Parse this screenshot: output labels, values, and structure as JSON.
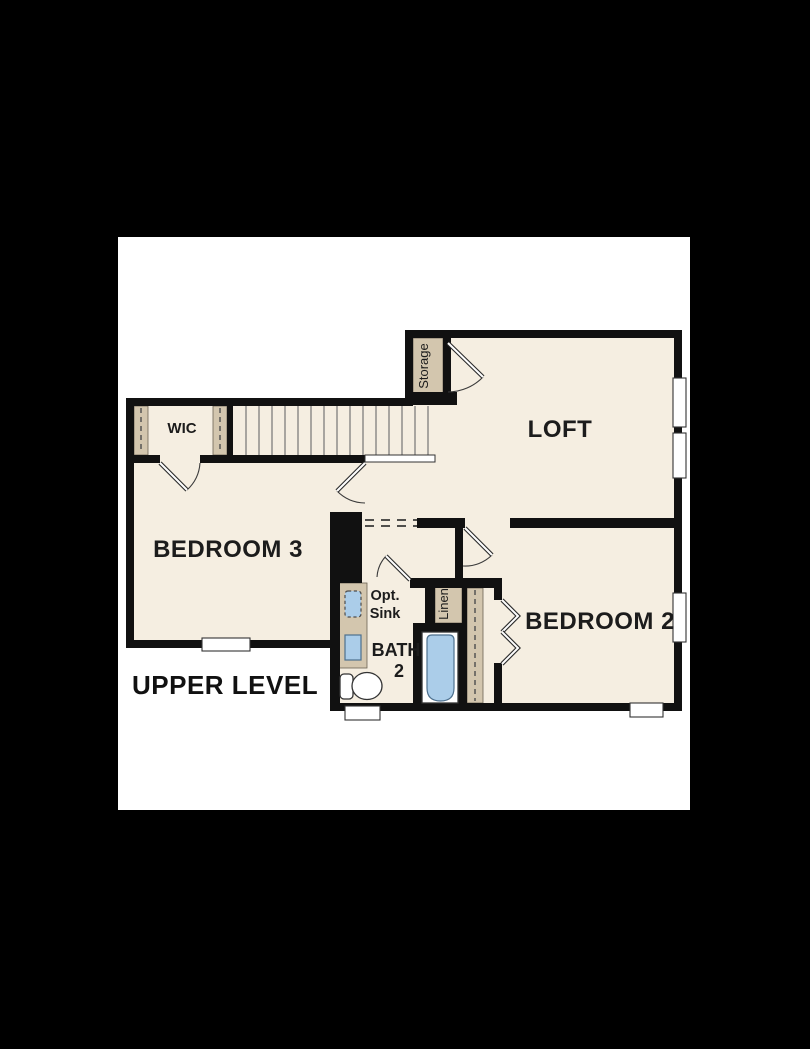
{
  "page": {
    "background_color": "#000000",
    "canvas_color": "#ffffff"
  },
  "floorplan": {
    "title": "UPPER LEVEL",
    "rooms": {
      "loft": "LOFT",
      "bedroom_3": "BEDROOM 3",
      "bedroom_2": "BEDROOM 2",
      "bath_line1": "BATH",
      "bath_line2": "2",
      "wic": "WIC",
      "storage": "Storage",
      "linen": "Linen"
    },
    "annotations": {
      "opt_sink_line1": "Opt.",
      "opt_sink_line2": "Sink"
    },
    "colors": {
      "wall": "#111111",
      "floor": "#f5eee1",
      "closet_tan": "#d3c6ae",
      "fixture_blue": "#abcde9",
      "stair_line": "#6a6a6a"
    }
  }
}
